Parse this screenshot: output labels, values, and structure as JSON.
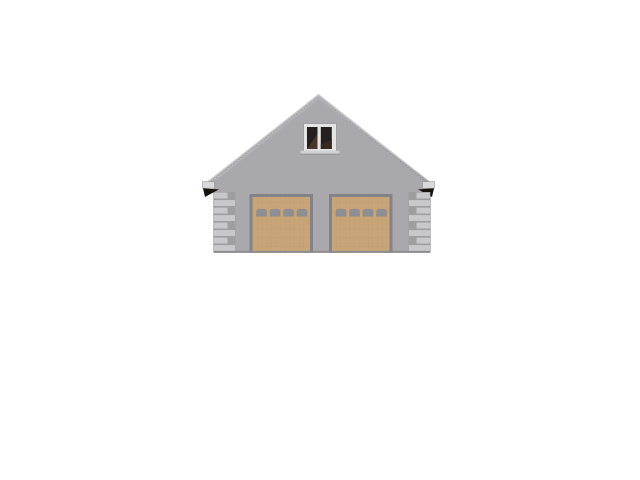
{
  "page": {
    "background": "#ffffff"
  },
  "scene": {
    "type": "architectural-elevation-render",
    "subject": "Front (gable-end) elevation of a two-car garage",
    "elements": {
      "roof": {
        "style": "gable",
        "eave_overhangs": 2
      },
      "attic_window": {
        "panes": 2
      },
      "garage_doors": {
        "count": 2,
        "lites_per_door": 4
      },
      "corner_quoins": {
        "columns": 2,
        "blocks_per_column": 8
      }
    }
  },
  "colors": {
    "background": "#ffffff",
    "wall": "#a9a9ad",
    "roof_fascia": "#b6b6b9",
    "roof_edge_light": "#c9c9cb",
    "roof_stipple": "#87878a",
    "gutter_cap": "#d9d9db",
    "eave_shadow": "#17130f",
    "quoin_block": "#c8c8ca",
    "quoin_mortar": "#9e9ea1",
    "corner_shadow": "#77777a",
    "door_frame": "#828288",
    "door_panel": "#c8a578",
    "door_grid_line": "#ab8a5a",
    "door_lite": "#8e8f94",
    "window_frame": "#e4e4e5",
    "window_pane": "#242020",
    "window_reflection_left": "#4a372b",
    "window_reflection_right": "#352921",
    "window_sill": "#d2d2d4",
    "sill_shadow": "#97979a",
    "base_shadow": "#8c8c8f"
  }
}
